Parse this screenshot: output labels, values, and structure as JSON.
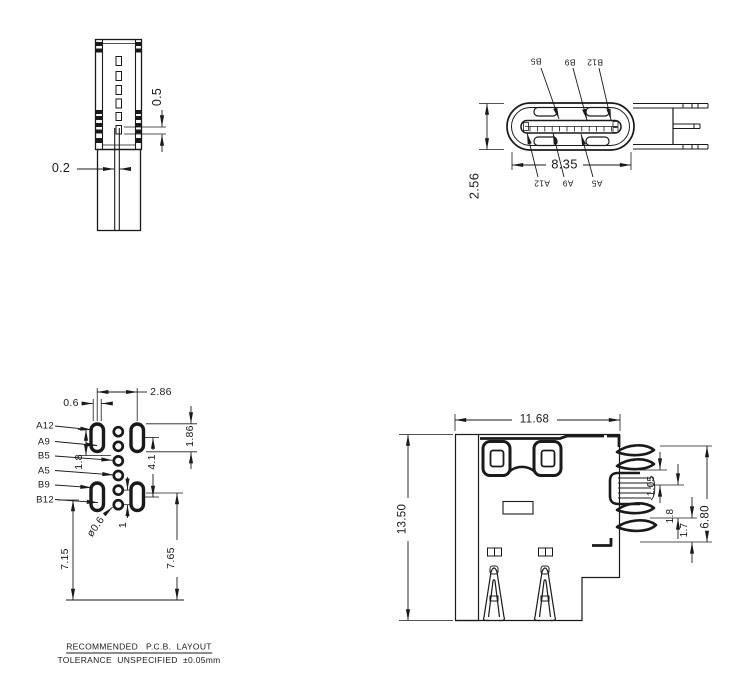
{
  "side_view": {
    "d05": "0.5",
    "d02": "0.2"
  },
  "front_view": {
    "d835": "8.35",
    "d256": "2.56",
    "pins_top": [
      "B5",
      "B9",
      "B12"
    ],
    "pins_bottom": [
      "A12",
      "A9",
      "A5"
    ]
  },
  "pcb_view": {
    "pads": [
      "A12",
      "A9",
      "B5",
      "A5",
      "B9",
      "B12"
    ],
    "d06": "0.6",
    "d286": "2.86",
    "d18": "1.8",
    "d41": "4.1",
    "d186": "1.86",
    "dhole": "ø0.6",
    "d1": "1",
    "d715": "7.15",
    "d765": "7.65"
  },
  "top_view": {
    "d1168": "11.68",
    "d1350": "13.50",
    "d680": "6.80",
    "d105": "1.05",
    "d18": "1.8",
    "d17": "1.7"
  },
  "footer": {
    "title": "RECOMMENDED   P.C.B.  LAYOUT",
    "tolerance": "TOLERANCE  UNSPECIFIED  ±0.05mm"
  }
}
